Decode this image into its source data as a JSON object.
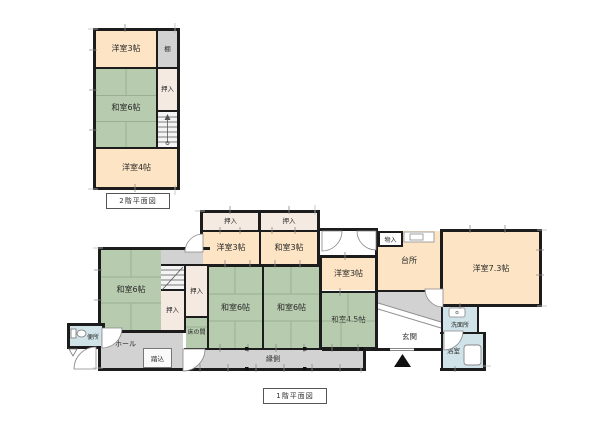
{
  "document": {
    "type": "japanese-floor-plan",
    "colors": {
      "wall": "#1c1c1c",
      "tatami_green": "#b7cbae",
      "tatami_line": "#9ab092",
      "wood_peach": "#fce4c4",
      "closet_cream": "#f5eae2",
      "floor_gray": "#d2d2d2",
      "wet_area_blue": "#cfe3e8"
    }
  },
  "floor2": {
    "caption": "2階平面図",
    "rooms": {
      "youshitsu3": {
        "label": "洋室3帖"
      },
      "tana": {
        "label": "棚"
      },
      "washitsu6": {
        "label": "和室6帖"
      },
      "oshiire": {
        "label": "押入"
      },
      "youshitsu4": {
        "label": "洋室4帖"
      }
    }
  },
  "floor1": {
    "caption": "1階平面図",
    "rooms": {
      "oshiireA": {
        "label": "押入"
      },
      "oshiireB": {
        "label": "押入"
      },
      "youshitsu3Top": {
        "label": "洋室3帖"
      },
      "washitsu3": {
        "label": "和室3帖"
      },
      "washitsu6Left": {
        "label": "和室6帖"
      },
      "oshiireC": {
        "label": "押入"
      },
      "oshiireD": {
        "label": "押入"
      },
      "washitsu6C1": {
        "label": "和室6帖"
      },
      "washitsu6C2": {
        "label": "和室6帖"
      },
      "youshitsu3Right": {
        "label": "洋室3帖"
      },
      "washitsu45": {
        "label": "和室4.5帖"
      },
      "monoire": {
        "label": "物入"
      },
      "daidokoro": {
        "label": "台所"
      },
      "youshitsu73": {
        "label": "洋室7.3帖"
      },
      "genkan": {
        "label": "玄関"
      },
      "senmenjo": {
        "label": "洗面所"
      },
      "yokushitsu": {
        "label": "浴室"
      },
      "benjo": {
        "label": "便所"
      },
      "hall": {
        "label": "ホール"
      },
      "fumikomi": {
        "label": "踏込"
      },
      "tokonoma": {
        "label": "床の間"
      },
      "engawa": {
        "label": "縁側"
      }
    }
  }
}
